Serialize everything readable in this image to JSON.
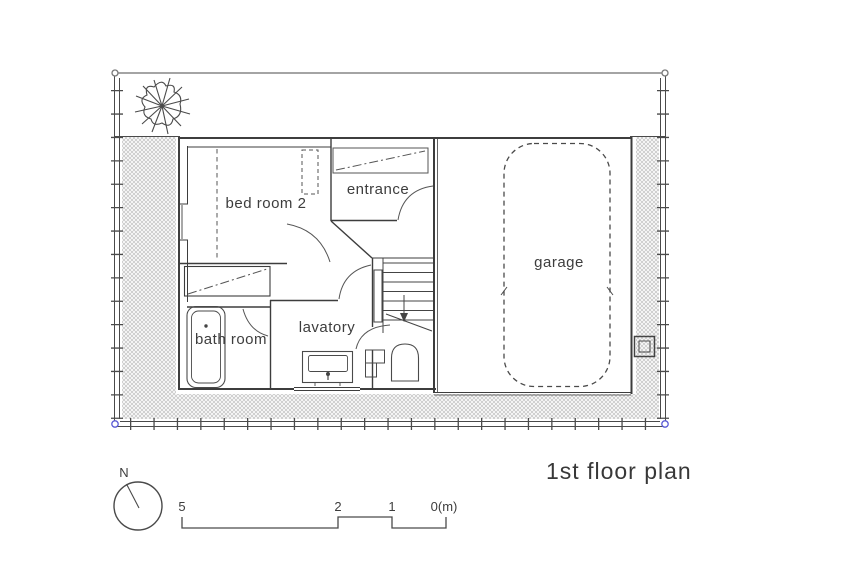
{
  "drawing": {
    "title": "1st floor plan",
    "rooms": {
      "bedroom2": "bed room 2",
      "entrance": "entrance",
      "garage": "garage",
      "lavatory": "lavatory",
      "bathroom": "bath room"
    },
    "compass": {
      "north_label": "N"
    },
    "scale_bar": {
      "labels": [
        "5",
        "2",
        "1",
        "0(m)"
      ]
    },
    "colors": {
      "line": "#3d3d3d",
      "fixture_line": "#4a4a4a",
      "hatch": "#c9c9c9",
      "corner_marker_blue": "#5b5bd6",
      "corner_marker_gray": "#777777",
      "background": "#ffffff"
    }
  }
}
